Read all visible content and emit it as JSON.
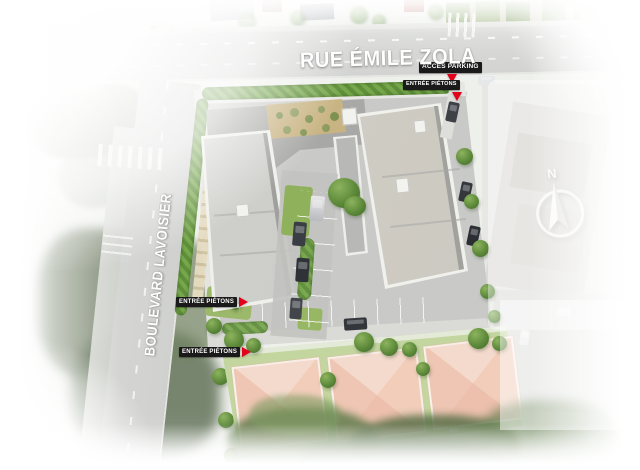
{
  "scene": {
    "type": "aerial-masterplan-render",
    "width_px": 640,
    "height_px": 470,
    "new_buildings_count": 2,
    "pink_roof_houses_count": 3
  },
  "streets": {
    "rue": {
      "name": "RUE ÉMILE ZOLA",
      "orientation": "horizontal-top"
    },
    "boulevard": {
      "name": "BOULEVARD LAVOISIER",
      "orientation": "diagonal-left"
    }
  },
  "markers": {
    "parking": {
      "label": "ACCÈS PARKING",
      "arrow": "down"
    },
    "pietons_nord": {
      "label": "ENTRÉE PIÉTONS",
      "arrow": "down"
    },
    "pietons_ouest_haut": {
      "label": "ENTRÉE PIÉTONS",
      "arrow": "right"
    },
    "pietons_ouest_bas": {
      "label": "ENTRÉE PIÉTONS",
      "arrow": "right"
    }
  },
  "compass": {
    "north_label": "N"
  },
  "colors": {
    "marker_tag_bg": "#1a1a1a",
    "marker_tag_text": "#ffffff",
    "marker_arrow_red": "#e2001a",
    "street_label_text": "#ffffff",
    "new_roof_gray": "#cdcdc9",
    "dark_connector_roof": "#a8a9a6",
    "roof_garden_tan": "#c8b382",
    "pink_roof": "#f3ccbc",
    "lawn_green": "#8fb15c",
    "hedge_green": "#5e8f3a",
    "road_gray": "#d5d6d4"
  }
}
